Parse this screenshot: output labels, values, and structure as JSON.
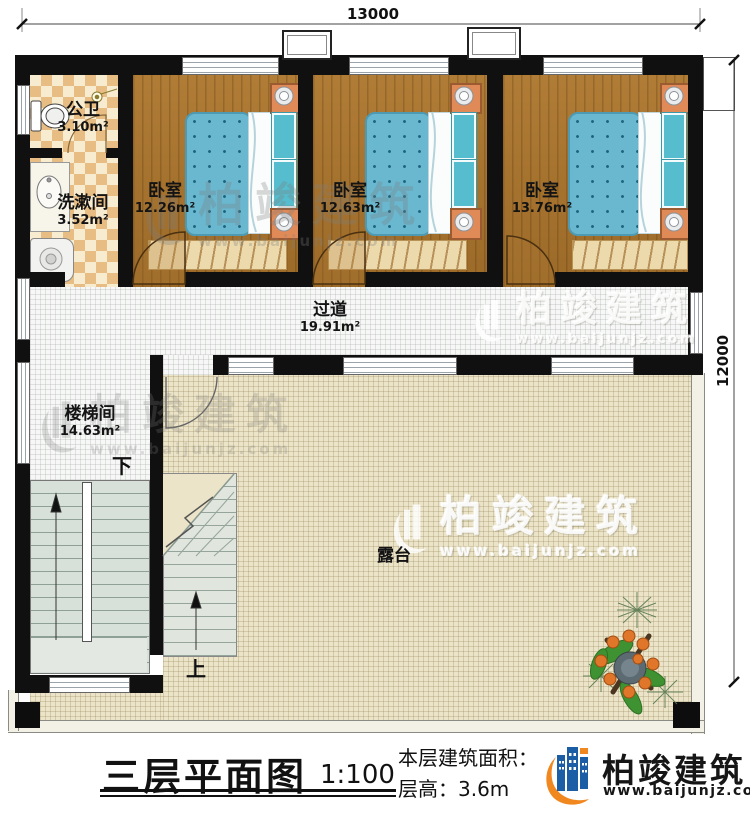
{
  "dimensions": {
    "top": "13000",
    "right": "12000"
  },
  "rooms": {
    "bath": {
      "name": "公卫",
      "area": "3.10m²"
    },
    "wash": {
      "name": "洗漱间",
      "area": "3.52m²"
    },
    "bed1": {
      "name": "卧室",
      "area": "12.26m²"
    },
    "bed2": {
      "name": "卧室",
      "area": "12.63m²"
    },
    "bed3": {
      "name": "卧室",
      "area": "13.76m²"
    },
    "corridor": {
      "name": "过道",
      "area": "19.91m²"
    },
    "stairwell": {
      "name": "楼梯间",
      "area": "14.63m²"
    },
    "terrace": {
      "name": "露台"
    }
  },
  "stairs": {
    "down_label": "下",
    "up_label": "上"
  },
  "title": {
    "main": "三层平面图",
    "scale": "1:100",
    "area_label": "本层建筑面积：",
    "height_label": "层高：",
    "height_value": "3.6m"
  },
  "brand": {
    "name": "柏竣建筑",
    "url": "www.baijunjz.com"
  },
  "watermark": {
    "name": "柏竣建筑",
    "url": "www.baijunjz.com"
  },
  "colors": {
    "wall": "#101010",
    "wood_floor": "#a9742e",
    "tile_floor": "#e9c285",
    "bed_blue": "#69b8d0",
    "nightstand_orange": "#e08a58",
    "terrace_floor": "#ece4c8",
    "brand_blue": "#1b5ea6",
    "brand_orange": "#f0871f"
  }
}
